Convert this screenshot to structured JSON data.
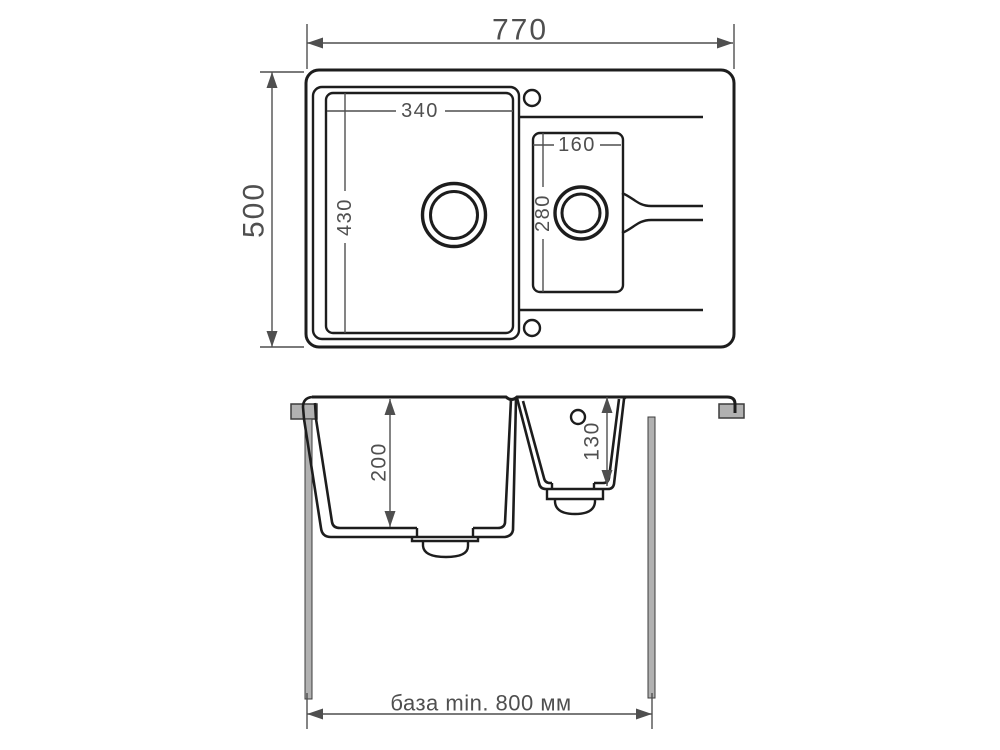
{
  "labels": {
    "overall_width": "770",
    "overall_depth": "500",
    "main_bowl_width": "340",
    "main_bowl_length": "430",
    "small_bowl_width": "160",
    "small_bowl_length": "280",
    "main_bowl_depth": "200",
    "small_bowl_depth": "130",
    "base_note": "база min. 800 мм"
  },
  "colors": {
    "line": "#1d1d1d",
    "dimension": "#4f4f4f",
    "cabinet_fill": "#b1b1b1",
    "background": "#ffffff"
  }
}
